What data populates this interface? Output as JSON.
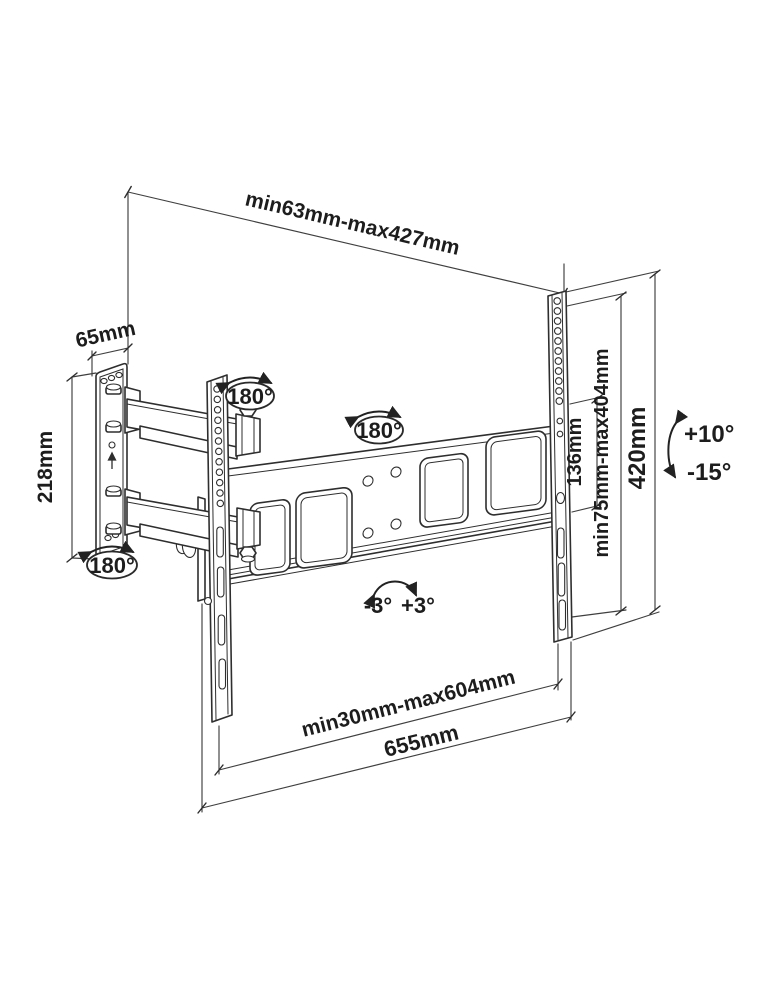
{
  "drawing": {
    "type": "tv-wall-mount-technical-drawing",
    "labels": {
      "top_span": "min63mm-max427mm",
      "plate_width": "65mm",
      "plate_height": "218mm",
      "swivel_rail_joint": "180°",
      "swivel_center_joint": "180°",
      "swivel_wall_joint": "180°",
      "hole_spacing": "136mm",
      "vesa_range": "min75mm-max404mm",
      "bracket_height": "420mm",
      "tilt_up": "+10°",
      "tilt_down": "-15°",
      "level_ccw": "-3°",
      "level_cw": "+3°",
      "bottom_range": "min30mm-max604mm",
      "crossbar_width": "655mm"
    },
    "colors": {
      "line": "#2e2e2e",
      "dimension_line": "#3f3f3f",
      "text": "#1d1d1d",
      "background": "#ffffff"
    }
  }
}
